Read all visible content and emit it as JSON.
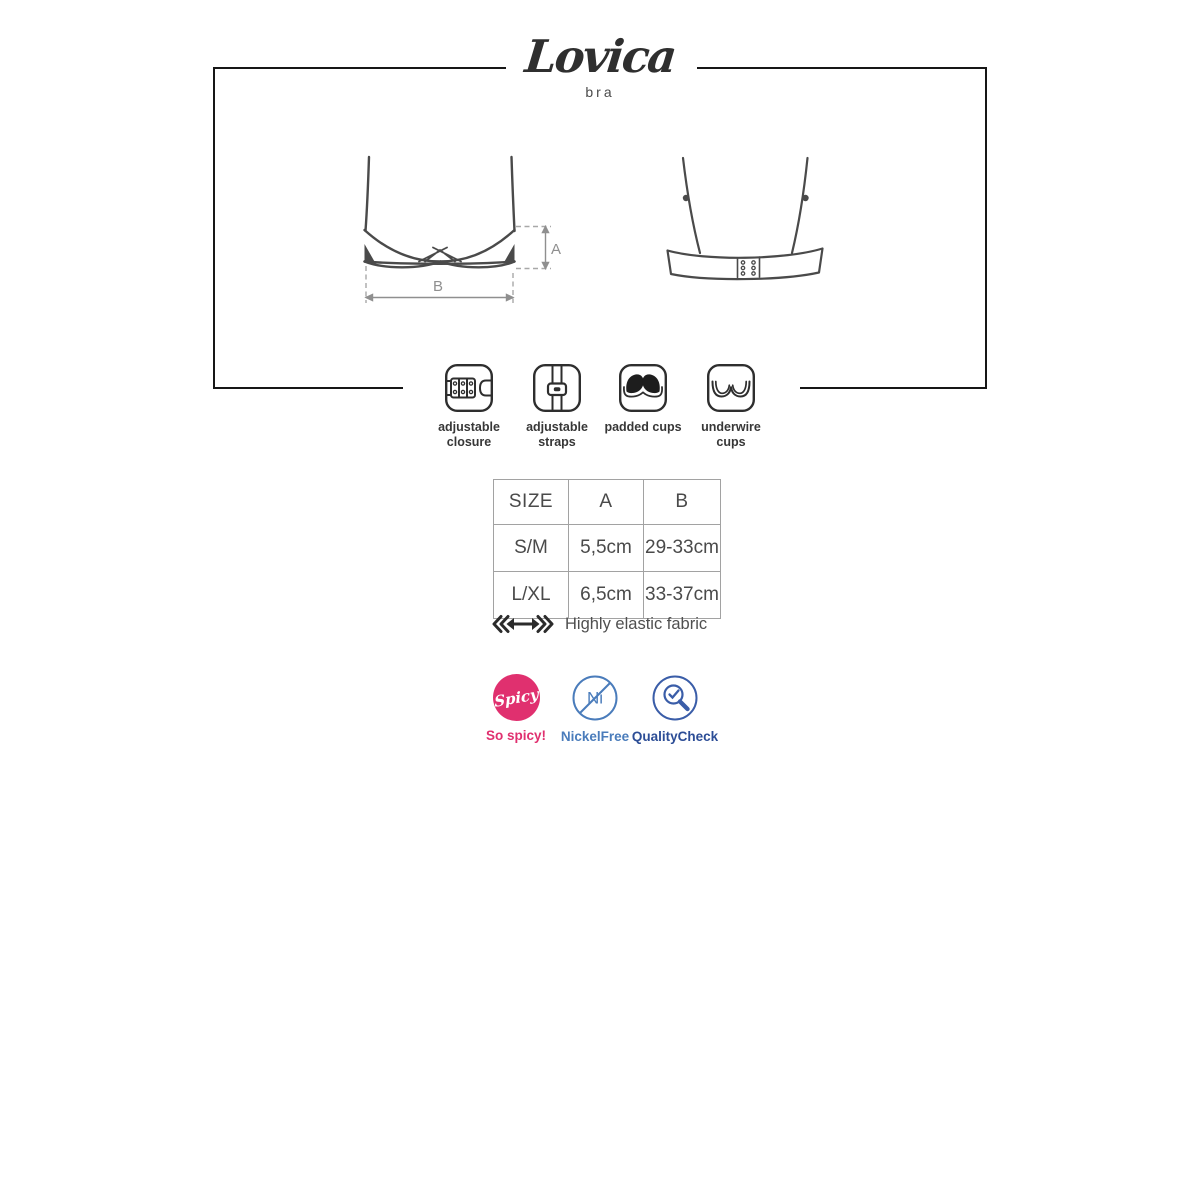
{
  "logo": {
    "title": "Lovica",
    "subtitle": "bra"
  },
  "diagram": {
    "front": {
      "dim_a": "A",
      "dim_b": "B"
    },
    "views": [
      "front-with-dimensions",
      "back-with-closure"
    ]
  },
  "features": {
    "items": [
      {
        "icon": "adjustable-closure-icon",
        "label": "adjustable closure"
      },
      {
        "icon": "adjustable-straps-icon",
        "label": "adjustable straps"
      },
      {
        "icon": "padded-cups-icon",
        "label": "padded cups"
      },
      {
        "icon": "underwire-cups-icon",
        "label": "underwire cups"
      }
    ]
  },
  "size_table": {
    "headers": [
      "SIZE",
      "A",
      "B"
    ],
    "rows": [
      [
        "S/M",
        "5,5cm",
        "29-33cm"
      ],
      [
        "L/XL",
        "6,5cm",
        "33-37cm"
      ]
    ]
  },
  "elastic": {
    "icon": "elastic-arrow-icon",
    "label": "Highly elastic fabric"
  },
  "badges": {
    "spicy": {
      "circle_text": "Spicy",
      "label": "So spicy!",
      "color": "#e0306f"
    },
    "nickel_free": {
      "symbol": "Ni",
      "label": "NickelFree",
      "color": "#4a7cbb"
    },
    "quality_check": {
      "label": "QualityCheck",
      "color": "#2c4d96"
    }
  },
  "colors": {
    "frame": "#171717",
    "outline": "#4a4a4a",
    "dimension": "#8f8f8f",
    "table_border": "#a2a2a2",
    "label_text": "#373737"
  }
}
